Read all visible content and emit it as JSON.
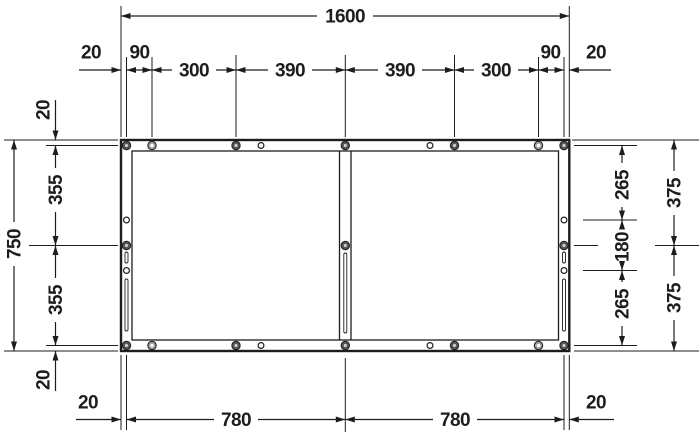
{
  "diagram": {
    "type": "technical-dimension-drawing",
    "subject": "Rectangular support frame, top view with fixing points and mounting slots",
    "units": "mm",
    "frame_width_mm": 1600,
    "frame_height_mm": 750,
    "labels": {
      "total_width": "1600",
      "top": [
        "20",
        "90",
        "300",
        "390",
        "390",
        "300",
        "90",
        "20"
      ],
      "bottom": [
        "20",
        "780",
        "780",
        "20"
      ],
      "left_total": "750",
      "left": [
        "20",
        "355",
        "355",
        "20"
      ],
      "right_inner": [
        "265",
        "180",
        "265"
      ],
      "right_outer": [
        "375",
        "375"
      ]
    },
    "fasteners": {
      "dark_screws": 13,
      "light_screws": 4,
      "open_holes": 8,
      "slotted_holes": 5
    },
    "colors": {
      "line": "#1d1d1b",
      "screw_dark": "#575756",
      "screw_light": "#9d9d9c",
      "hole_fill": "#ffffff",
      "background": "#ffffff"
    }
  }
}
